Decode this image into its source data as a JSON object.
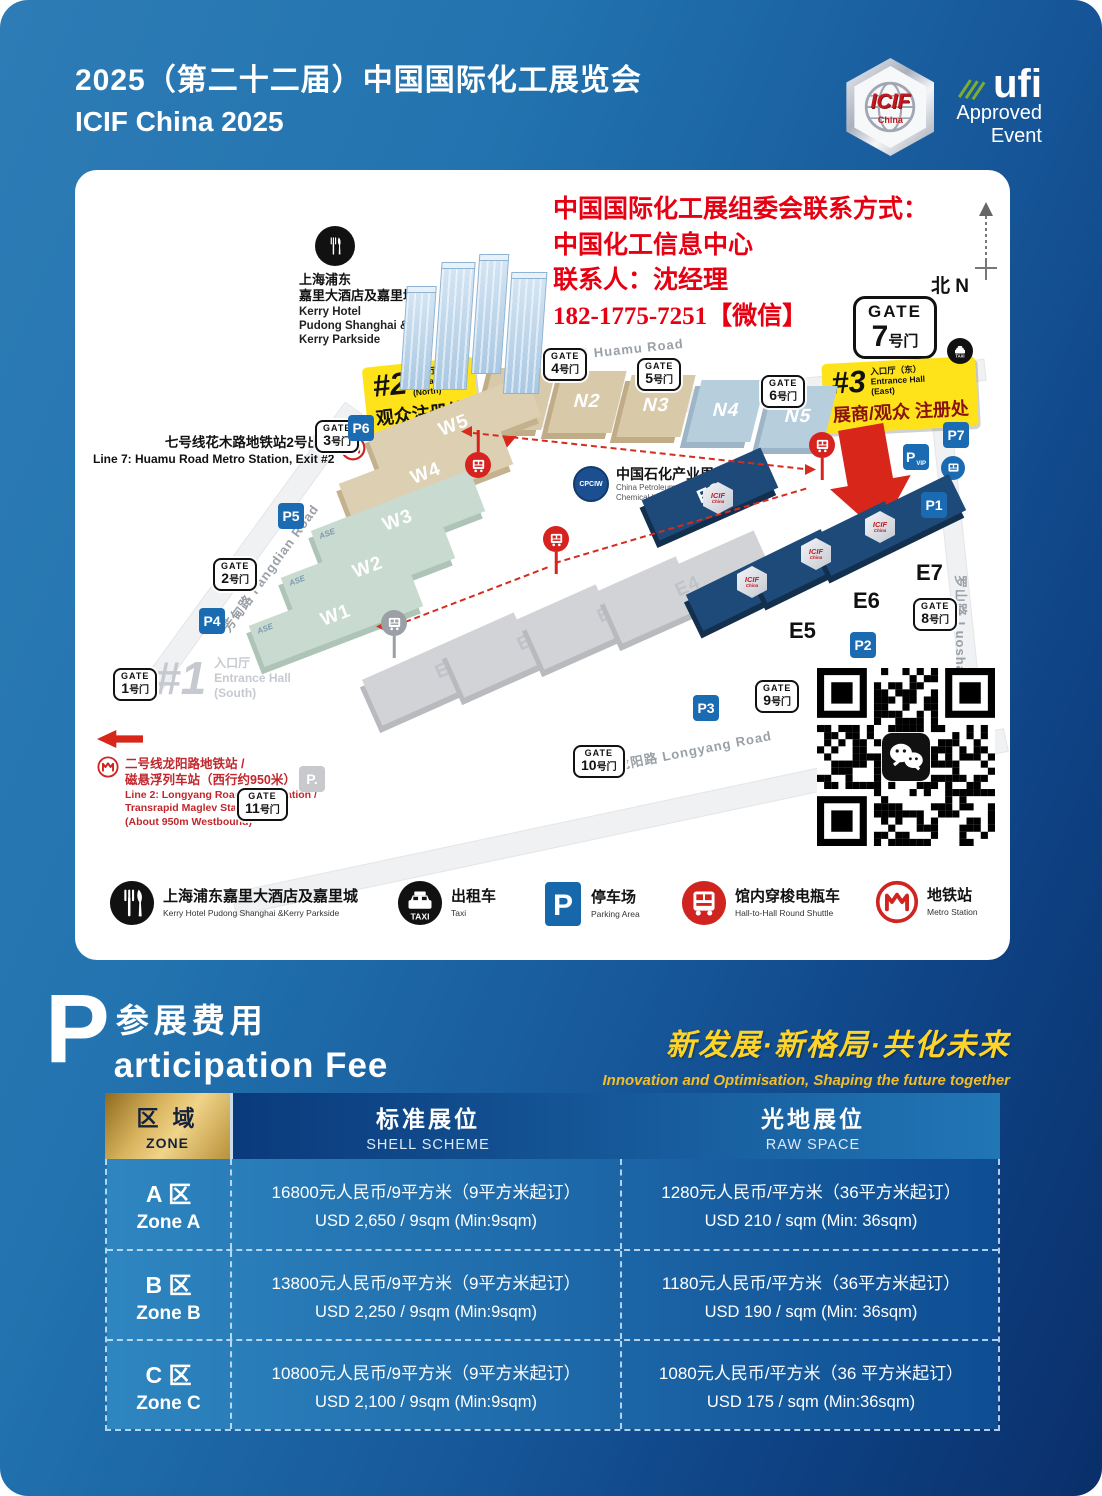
{
  "colors": {
    "accent_red": "#e60012",
    "callout_yellow": "#ffe31a",
    "deep_navy": "#0a2f6a",
    "hall_navy": "#1d4a78",
    "table_gold": "#d7b25c",
    "slogan_yellow": "#ffd428"
  },
  "header": {
    "title_zh": "2025（第二十二届）中国国际化工展览会",
    "title_en": "ICIF China 2025",
    "icif": {
      "text": "ICIF",
      "sub": "China"
    },
    "ufi": {
      "name": "ufi",
      "line1": "Approved",
      "line2": "Event"
    }
  },
  "map": {
    "contact": {
      "l1": "中国国际化工展组委会联系方式：",
      "l2": "中国化工信息中心",
      "l3": "联系人：沈经理",
      "l4": "182-1775-7251【微信】"
    },
    "compass": {
      "zh": "北",
      "en": "N"
    },
    "hotel": {
      "zh1": "上海浦东",
      "zh2": "嘉里大酒店及嘉里城",
      "en1": "Kerry Hotel",
      "en2": "Pudong Shanghai &",
      "en3": "Kerry Parkside"
    },
    "line7": {
      "zh": "七号线花木路地铁站2号出口",
      "en": "Line 7: Huamu Road Metro Station, Exit #2"
    },
    "line2": {
      "zh1": "二号线龙阳路地铁站 /",
      "zh2": "磁悬浮列车站（西行约950米）",
      "en1": "Line 2: Longyang Road Metro Station /",
      "en2": "Transrapid Maglev Station",
      "en3": "(About 950m Westbound)"
    },
    "roads": {
      "huamu": "花木路  Huamu Road",
      "fangdian": "芳甸路  Fangdian Road",
      "longyang": "龙阳路  Longyang Road",
      "luoshan": "罗山路  Luoshan Road"
    },
    "gate7": {
      "en": "GATE",
      "num": "7",
      "suffix": "号门"
    },
    "gates": [
      {
        "id": "g1",
        "en": "GATE",
        "zh": "1号门"
      },
      {
        "id": "g2",
        "en": "GATE",
        "zh": "2号门"
      },
      {
        "id": "g3",
        "en": "GATE",
        "zh": "3号门"
      },
      {
        "id": "g4",
        "en": "GATE",
        "zh": "4号门"
      },
      {
        "id": "g5",
        "en": "GATE",
        "zh": "5号门"
      },
      {
        "id": "g6",
        "en": "GATE",
        "zh": "6号门"
      },
      {
        "id": "g8",
        "en": "GATE",
        "zh": "8号门"
      },
      {
        "id": "g9",
        "en": "GATE",
        "zh": "9号门"
      },
      {
        "id": "g10",
        "en": "GATE",
        "zh": "10号门"
      },
      {
        "id": "g11",
        "en": "GATE",
        "zh": "11号门"
      }
    ],
    "entrance1": {
      "num": "#1",
      "zh": "入口厅（南）",
      "en1": "Entrance Hall",
      "en2": "(South)"
    },
    "entrance2": {
      "num": "#2",
      "zh": "入口厅（北）",
      "en1": "Entrance Hall",
      "en2": "(North)",
      "sub": "观众注册处"
    },
    "entrance3": {
      "num": "#3",
      "zh": "入口厅（东）",
      "en1": "Entrance Hall",
      "en2": "(East)",
      "sub": "展商/观众 注册处"
    },
    "ase_label": "ASE",
    "cpciw": {
      "zh": "中国石化产业周",
      "en1": "China Petroleum and",
      "en2": "Chemical Industry Week"
    },
    "icif_badge": {
      "text": "ICIF",
      "sub": "China"
    },
    "halls": [
      {
        "id": "N1",
        "label": "N1",
        "type": "beige"
      },
      {
        "id": "N2",
        "label": "N2",
        "type": "beige"
      },
      {
        "id": "N3",
        "label": "N3",
        "type": "beige"
      },
      {
        "id": "N4",
        "label": "N4",
        "type": "lightblue"
      },
      {
        "id": "N5",
        "label": "N5",
        "type": "lightblue"
      },
      {
        "id": "W5",
        "label": "W5",
        "type": "tan"
      },
      {
        "id": "W4",
        "label": "W4",
        "type": "tan"
      },
      {
        "id": "W3",
        "label": "W3",
        "type": "green",
        "ase": true
      },
      {
        "id": "W2",
        "label": "W2",
        "type": "green",
        "ase": true
      },
      {
        "id": "W1",
        "label": "W1",
        "type": "green",
        "ase": true
      },
      {
        "id": "E1",
        "label": "E1",
        "type": "gray"
      },
      {
        "id": "E2",
        "label": "E2",
        "type": "gray"
      },
      {
        "id": "E3",
        "label": "E3",
        "type": "gray"
      },
      {
        "id": "E4",
        "label": "E4",
        "type": "gray"
      },
      {
        "id": "E8",
        "label": "E8",
        "type": "navy"
      },
      {
        "id": "E5s",
        "label": "",
        "type": "navy"
      },
      {
        "id": "E6s",
        "label": "",
        "type": "navy"
      },
      {
        "id": "E7s",
        "label": "",
        "type": "navy"
      }
    ],
    "hall_labels": [
      {
        "id": "E5",
        "label": "E5"
      },
      {
        "id": "E6",
        "label": "E6"
      },
      {
        "id": "E7",
        "label": "E7"
      }
    ],
    "parks": [
      {
        "id": "P1",
        "label": "P1"
      },
      {
        "id": "P2",
        "label": "P2"
      },
      {
        "id": "P3",
        "label": "P3"
      },
      {
        "id": "P4",
        "label": "P4"
      },
      {
        "id": "P5",
        "label": "P5"
      },
      {
        "id": "P6",
        "label": "P6"
      },
      {
        "id": "P7",
        "label": "P7"
      },
      {
        "id": "Pvip",
        "label": "P",
        "sub": "VIP"
      },
      {
        "id": "Pgray",
        "label": "P."
      }
    ],
    "legend": [
      {
        "icon": "restaurant-icon",
        "zh": "上海浦东嘉里大酒店及嘉里城",
        "en": "Kerry Hotel Pudong Shanghai &Kerry Parkside"
      },
      {
        "icon": "taxi-icon",
        "zh": "出租车",
        "en": "Taxi"
      },
      {
        "icon": "parking-icon",
        "zh": "停车场",
        "en": "Parking Area"
      },
      {
        "icon": "shuttle-icon",
        "zh": "馆内穿梭电瓶车",
        "en": "Hall-to-Hall Round Shuttle"
      },
      {
        "icon": "metro-icon",
        "zh": "地铁站",
        "en": "Metro Station"
      }
    ]
  },
  "participation": {
    "letter": "P",
    "zh": "参展费用",
    "en": "articipation Fee"
  },
  "slogan": {
    "zh": "新发展·新格局·共化未来",
    "en": "Innovation and Optimisation, Shaping the future together"
  },
  "table": {
    "header": {
      "zone_zh": "区 域",
      "zone_en": "ZONE",
      "shell_zh": "标准展位",
      "shell_en": "SHELL SCHEME",
      "raw_zh": "光地展位",
      "raw_en": "RAW SPACE"
    },
    "rows": [
      {
        "zone_zh": "A 区",
        "zone_en": "Zone A",
        "shell_zh": "16800元人民币/9平方米（9平方米起订）",
        "shell_en": "USD 2,650 / 9sqm (Min:9sqm)",
        "raw_zh": "1280元人民币/平方米（36平方米起订）",
        "raw_en": "USD 210 / sqm (Min: 36sqm)"
      },
      {
        "zone_zh": "B 区",
        "zone_en": "Zone B",
        "shell_zh": "13800元人民币/9平方米（9平方米起订）",
        "shell_en": "USD 2,250 / 9sqm (Min:9sqm)",
        "raw_zh": "1180元人民币/平方米（36平方米起订）",
        "raw_en": "USD 190 / sqm (Min: 36sqm)"
      },
      {
        "zone_zh": "C 区",
        "zone_en": "Zone C",
        "shell_zh": "10800元人民币/9平方米（9平方米起订）",
        "shell_en": "USD 2,100 / 9sqm (Min:9sqm)",
        "raw_zh": "1080元人民币/平方米（36 平方米起订）",
        "raw_en": "USD 175 / sqm (Min:36sqm)"
      }
    ]
  }
}
